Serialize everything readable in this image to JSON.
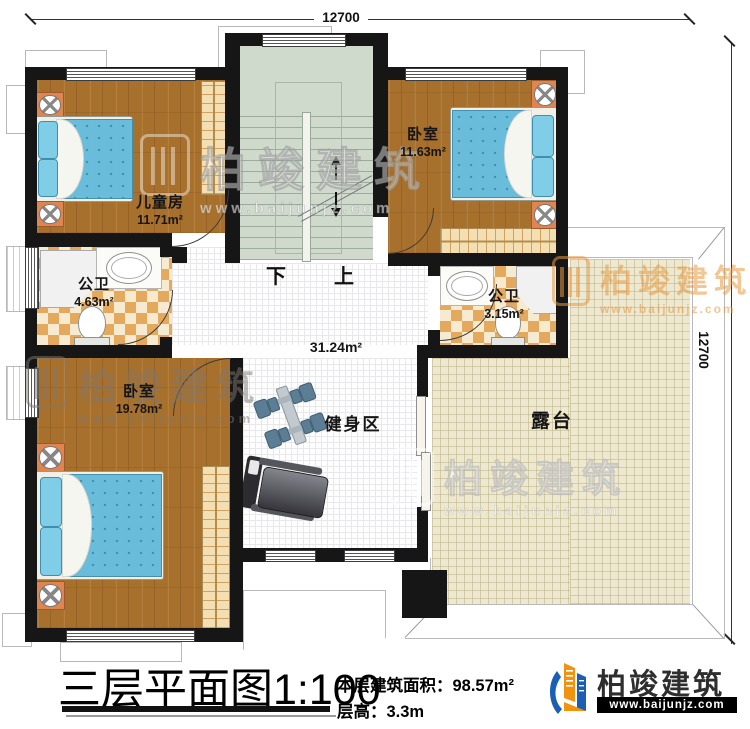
{
  "title": {
    "plan": "三层平面图",
    "scale": "1:100",
    "area_label": "本层建筑面积：",
    "area_value": "98.57m²",
    "height_label": "层高：",
    "height_value": "3.3m"
  },
  "brand": {
    "name": "柏竣建筑",
    "site": "www.baijunjz.com"
  },
  "dims": {
    "top": "12700",
    "right": "12700"
  },
  "stairs": {
    "down": "下",
    "up": "上"
  },
  "rooms": {
    "children": {
      "name": "儿童房",
      "area": "11.71m²"
    },
    "bedroom_tr": {
      "name": "卧室",
      "area": "11.63m²"
    },
    "bath_left": {
      "name": "公卫",
      "area": "4.63m²"
    },
    "bath_right": {
      "name": "公卫",
      "area": "3.15m²"
    },
    "bedroom_bl": {
      "name": "卧室",
      "area": "19.78m²"
    },
    "gym": {
      "name": "健身区",
      "area": "31.24m²"
    },
    "terrace": {
      "name": "露台"
    }
  },
  "watermark": {
    "name": "柏竣建筑",
    "site": "www.baijunjz.com"
  },
  "colors": {
    "wall": "#161616",
    "wood": "#a8702d",
    "stairs": "#cfdacd",
    "tile": "#e5a95e",
    "terrace": "#ede8cf",
    "mattress": "#69bdda",
    "logo_blue": "#1a5fb4",
    "logo_orange": "#f2930f"
  }
}
